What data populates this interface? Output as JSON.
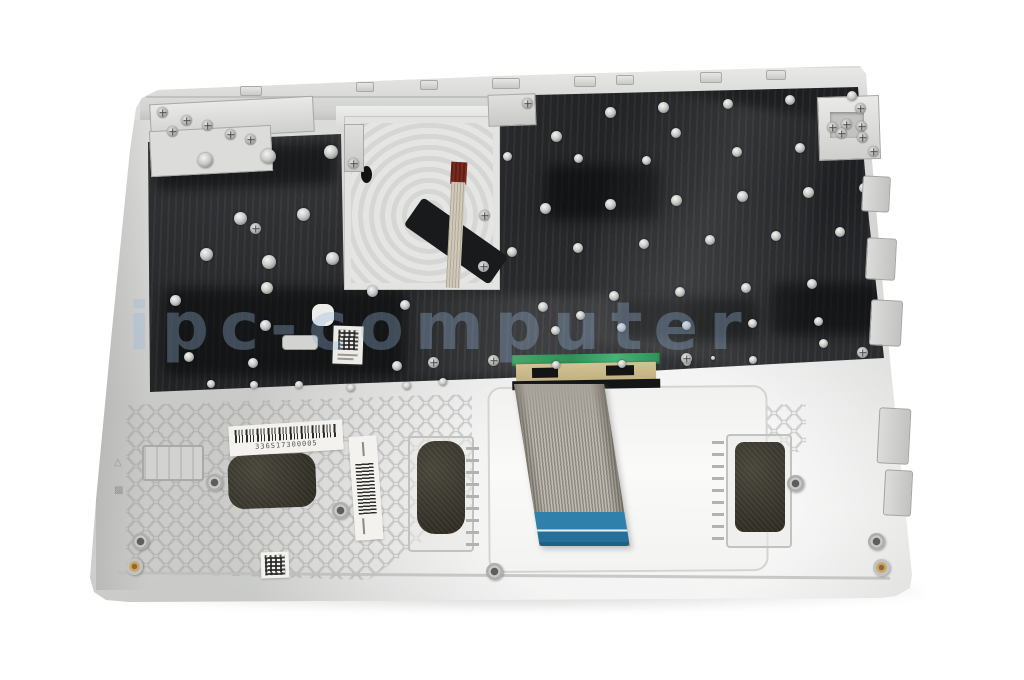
{
  "photo": {
    "subject": "Laptop top case / palmrest with keyboard assembly, underside view, product photo on white background",
    "background_color": "#ffffff"
  },
  "watermark": {
    "text": "ipc-computer"
  },
  "stickers": {
    "barcode_number": "336S17300005"
  },
  "colors": {
    "chassis_silver": "#d6d7d5",
    "keyboard_backplate": "#1d1e20",
    "ribbon_cable_gray": "#aaa59c",
    "ribbon_tip_blue": "#2c7aa5",
    "connector_tape_green": "#3aa266",
    "touchpad_cable_maroon": "#7c2b1e",
    "foam_pad_dark": "#35332a",
    "label_white": "#f3f2ef"
  }
}
